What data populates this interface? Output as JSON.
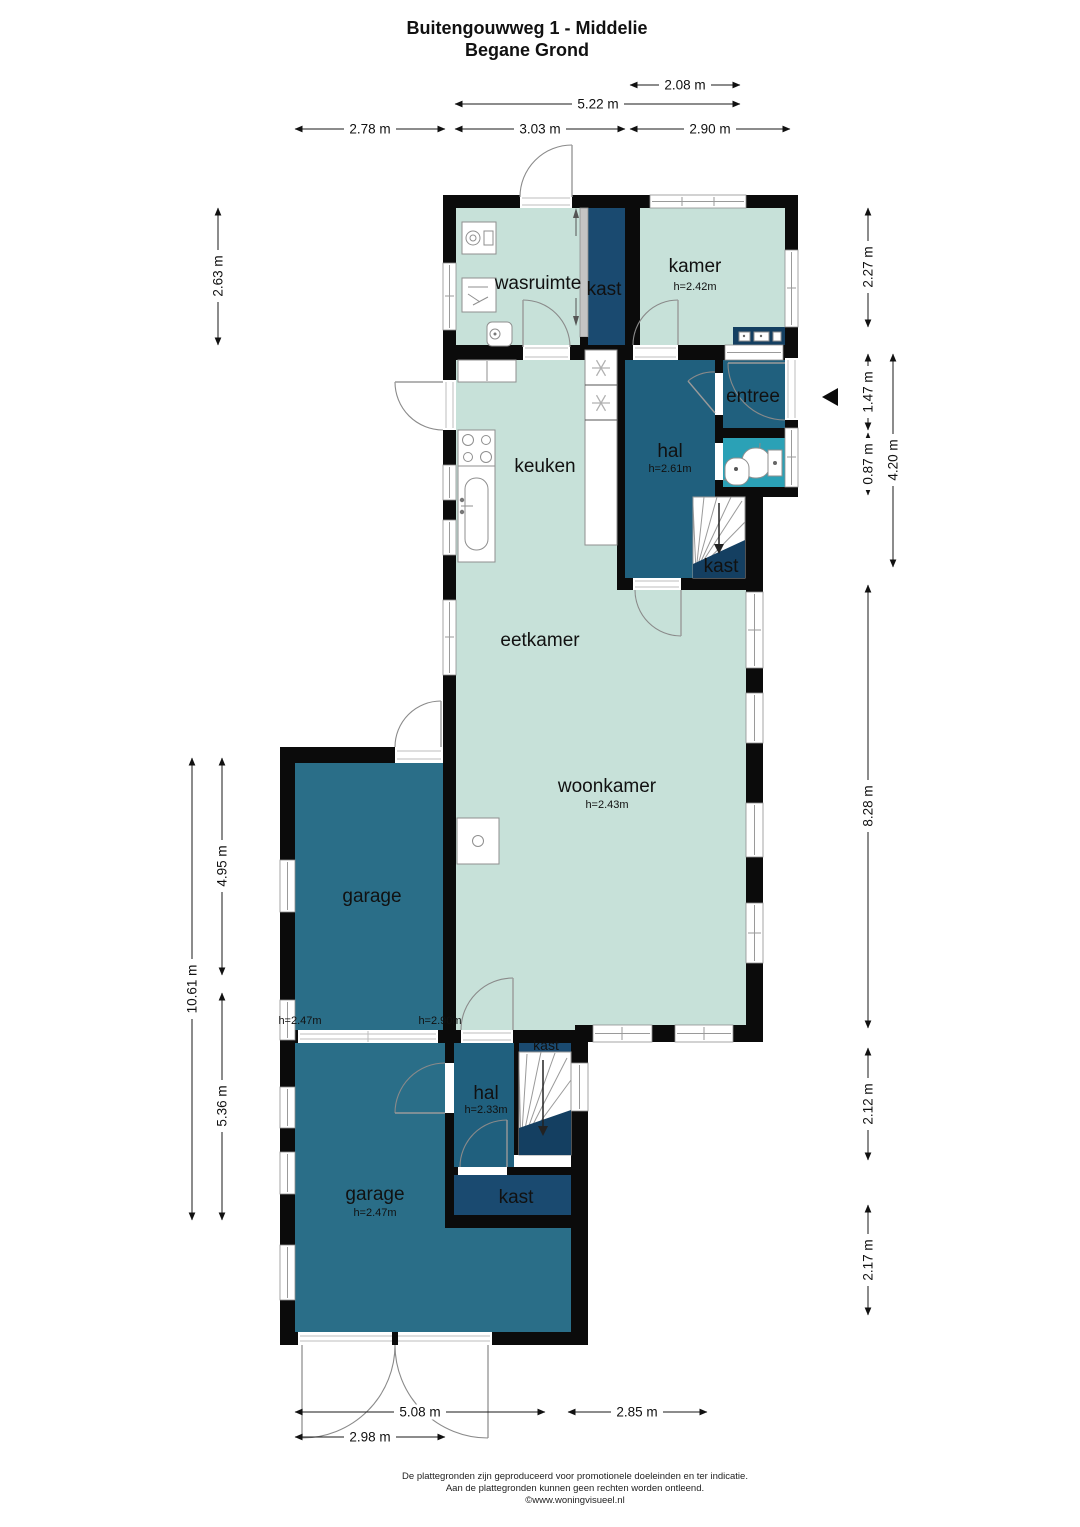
{
  "title": {
    "line1": "Buitengouwweg 1 - Middelie",
    "line2": "Begane Grond"
  },
  "rooms": {
    "wasruimte": {
      "label": "wasruimte"
    },
    "kast_top": {
      "label": "kast"
    },
    "kamer": {
      "label": "kamer",
      "height": "h=2.42m"
    },
    "keuken": {
      "label": "keuken"
    },
    "hal": {
      "label": "hal",
      "height": "h=2.61m"
    },
    "entree": {
      "label": "entree"
    },
    "kast_stairs": {
      "label": "kast"
    },
    "eetkamer": {
      "label": "eetkamer"
    },
    "woonkamer": {
      "label": "woonkamer",
      "height": "h=2.43m"
    },
    "garage1": {
      "label": "garage",
      "height_left": "h=2.47m",
      "height_right": "h=2.90m"
    },
    "hal2": {
      "label": "hal",
      "height": "h=2.33m"
    },
    "kast_boven_trap": {
      "label": "kast"
    },
    "kast_onder": {
      "label": "kast"
    },
    "garage2": {
      "label": "garage",
      "height": "h=2.47m"
    }
  },
  "dimensions": {
    "top1": "2.08 m",
    "top2": "5.22 m",
    "top3": "2.78 m",
    "top4": "3.03 m",
    "top5": "2.90 m",
    "left1": "2.63 m",
    "left2": "4.95 m",
    "left3": "10.61 m",
    "left4": "5.36 m",
    "right1": "2.27 m",
    "right2": "1.47 m",
    "right3": "0.87 m",
    "right4": "4.20 m",
    "right5": "8.28 m",
    "right6": "2.12 m",
    "right7": "2.17 m",
    "bottom1": "5.08 m",
    "bottom2": "2.85 m",
    "bottom3": "2.98 m"
  },
  "footer": {
    "line1": "De plattegronden zijn geproduceerd voor promotionele doeleinden en ter indicatie.",
    "line2": "Aan de plattegronden kunnen geen rechten worden ontleend.",
    "line3": "©www.woningvisueel.nl"
  },
  "colors": {
    "room_light": "#c7e1d9",
    "room_hall": "#20607e",
    "room_garage": "#2a6e88",
    "closet": "#1a4a70",
    "closet_dark": "#143f61",
    "toilet": "#2ba1b6",
    "wall": "#0b0b0b"
  }
}
